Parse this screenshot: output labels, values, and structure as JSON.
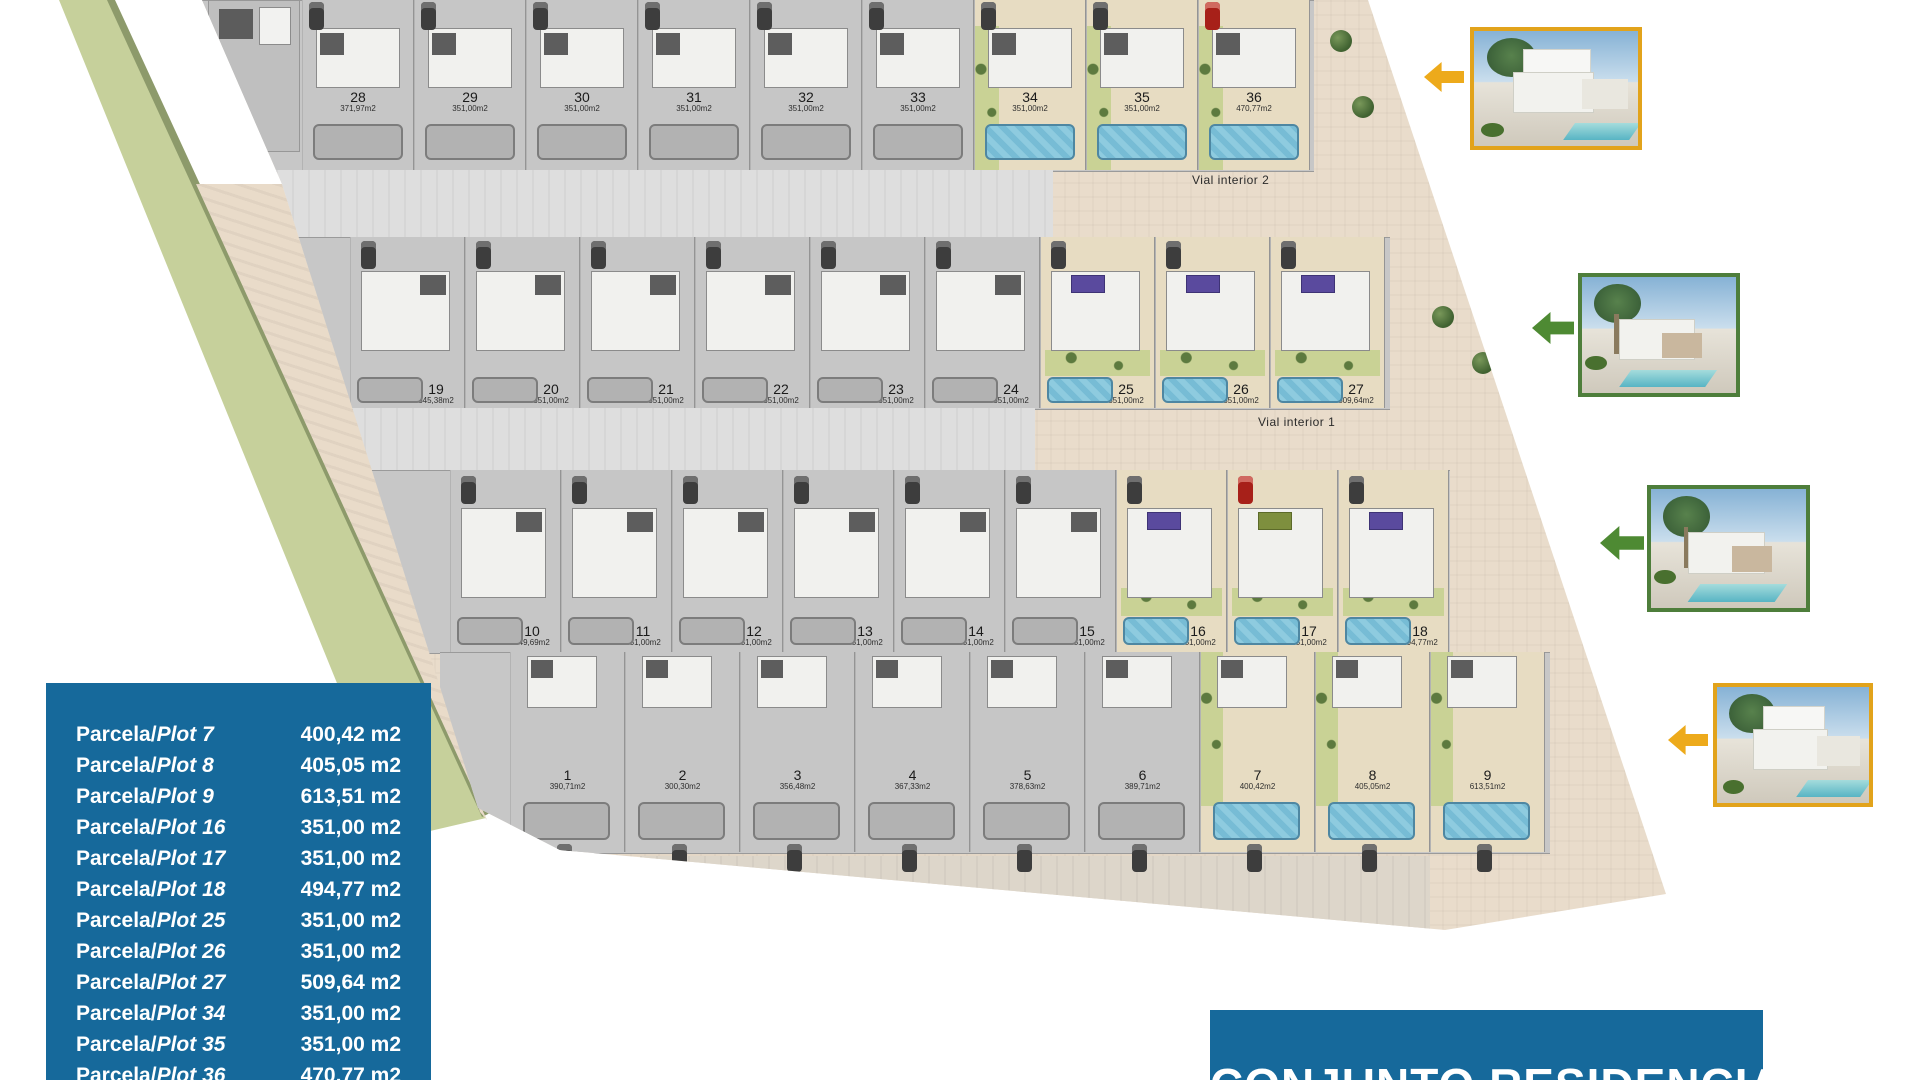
{
  "colors": {
    "accent_blue": "#16699B",
    "gold": "#E7A71C",
    "green": "#4E7E3B",
    "pool_blue": "#7FC6DC",
    "garden_green": "#C9D295",
    "highlight_beige": "#E7DCC2",
    "panel_purple": "#5A4A9E"
  },
  "banner": {
    "title": "CONJUNTO RESIDENCIAL"
  },
  "info_panel": {
    "rows": [
      {
        "prefix": "Parcela/",
        "plot": "Plot 7",
        "area": "400,42 m2"
      },
      {
        "prefix": "Parcela/",
        "plot": "Plot 8",
        "area": "405,05 m2"
      },
      {
        "prefix": "Parcela/",
        "plot": "Plot 9",
        "area": "613,51 m2"
      },
      {
        "prefix": "Parcela/",
        "plot": "Plot 16",
        "area": "351,00 m2"
      },
      {
        "prefix": "Parcela/",
        "plot": "Plot 17",
        "area": "351,00 m2"
      },
      {
        "prefix": "Parcela/",
        "plot": "Plot 18",
        "area": "494,77 m2"
      },
      {
        "prefix": "Parcela/",
        "plot": "Plot 25",
        "area": "351,00 m2"
      },
      {
        "prefix": "Parcela/",
        "plot": "Plot 26",
        "area": "351,00 m2"
      },
      {
        "prefix": "Parcela/",
        "plot": "Plot 27",
        "area": "509,64 m2"
      },
      {
        "prefix": "Parcela/",
        "plot": "Plot 34",
        "area": "351,00 m2"
      },
      {
        "prefix": "Parcela/",
        "plot": "Plot 35",
        "area": "351,00 m2"
      },
      {
        "prefix": "Parcela/",
        "plot": "Plot 36",
        "area": "470,77 m2"
      }
    ]
  },
  "plan": {
    "vial_label_2": "Vial interior 2",
    "vial_label_1": "Vial interior 1",
    "rows": [
      {
        "id": "row-28-36",
        "plots": [
          {
            "num": "28",
            "area": "371,97m2",
            "hl": false
          },
          {
            "num": "29",
            "area": "351,00m2",
            "hl": false
          },
          {
            "num": "30",
            "area": "351,00m2",
            "hl": false
          },
          {
            "num": "31",
            "area": "351,00m2",
            "hl": false
          },
          {
            "num": "32",
            "area": "351,00m2",
            "hl": false
          },
          {
            "num": "33",
            "area": "351,00m2",
            "hl": false
          },
          {
            "num": "34",
            "area": "351,00m2",
            "hl": true
          },
          {
            "num": "35",
            "area": "351,00m2",
            "hl": true
          },
          {
            "num": "36",
            "area": "470,77m2",
            "hl": true,
            "red": true
          }
        ]
      },
      {
        "id": "row-19-27",
        "plots": [
          {
            "num": "19",
            "area": "345,38m2",
            "hl": false
          },
          {
            "num": "20",
            "area": "351,00m2",
            "hl": false
          },
          {
            "num": "21",
            "area": "351,00m2",
            "hl": false
          },
          {
            "num": "22",
            "area": "351,00m2",
            "hl": false
          },
          {
            "num": "23",
            "area": "351,00m2",
            "hl": false
          },
          {
            "num": "24",
            "area": "351,00m2",
            "hl": false
          },
          {
            "num": "25",
            "area": "351,00m2",
            "hl": true
          },
          {
            "num": "26",
            "area": "351,00m2",
            "hl": true
          },
          {
            "num": "27",
            "area": "509,64m2",
            "hl": true
          }
        ]
      },
      {
        "id": "row-10-18",
        "plots": [
          {
            "num": "10",
            "area": "349,69m2",
            "hl": false
          },
          {
            "num": "11",
            "area": "351,00m2",
            "hl": false
          },
          {
            "num": "12",
            "area": "351,00m2",
            "hl": false
          },
          {
            "num": "13",
            "area": "351,00m2",
            "hl": false
          },
          {
            "num": "14",
            "area": "351,00m2",
            "hl": false
          },
          {
            "num": "15",
            "area": "351,00m2",
            "hl": false
          },
          {
            "num": "16",
            "area": "351,00m2",
            "hl": true
          },
          {
            "num": "17",
            "area": "351,00m2",
            "hl": true,
            "red": true,
            "panel": "green"
          },
          {
            "num": "18",
            "area": "494,77m2",
            "hl": true
          }
        ]
      },
      {
        "id": "row-1-9",
        "plots": [
          {
            "num": "1",
            "area": "390,71m2",
            "hl": false
          },
          {
            "num": "2",
            "area": "300,30m2",
            "hl": false
          },
          {
            "num": "3",
            "area": "356,48m2",
            "hl": false
          },
          {
            "num": "4",
            "area": "367,33m2",
            "hl": false
          },
          {
            "num": "5",
            "area": "378,63m2",
            "hl": false
          },
          {
            "num": "6",
            "area": "389,71m2",
            "hl": false
          },
          {
            "num": "7",
            "area": "400,42m2",
            "hl": true
          },
          {
            "num": "8",
            "area": "405,05m2",
            "hl": true
          },
          {
            "num": "9",
            "area": "613,51m2",
            "hl": true
          }
        ]
      }
    ]
  },
  "photos": [
    {
      "name": "villa-photo-top",
      "border_color": "#E2A31B",
      "arrow_color": "#EDAA1B",
      "style": "two-storey"
    },
    {
      "name": "villa-photo-row2",
      "border_color": "#4E7E3B",
      "arrow_color": "#4E8A33",
      "style": "one-storey"
    },
    {
      "name": "villa-photo-row3",
      "border_color": "#4E7E3B",
      "arrow_color": "#4E8A33",
      "style": "one-storey"
    },
    {
      "name": "villa-photo-bottom",
      "border_color": "#E2A31B",
      "arrow_color": "#EDAA1B",
      "style": "two-storey"
    }
  ]
}
